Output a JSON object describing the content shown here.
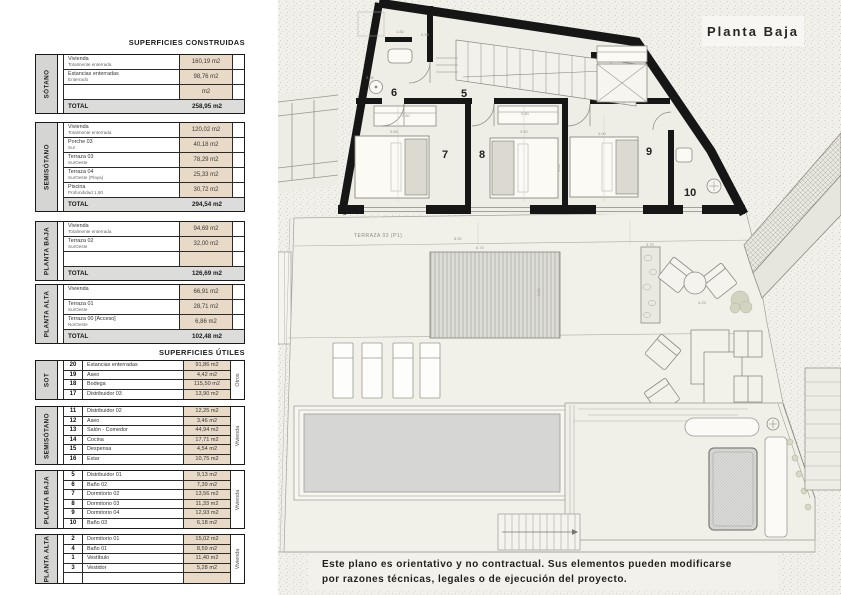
{
  "plan": {
    "title": "Planta Baja",
    "terraza_label": "TERRAZA 02 (P1)",
    "room_numbers": [
      "6",
      "5",
      "7",
      "8",
      "9",
      "10"
    ],
    "dims": [
      "1.82",
      "0.96",
      "2.35",
      "0.60",
      "3.50",
      "0.60",
      "3.50",
      "4.00",
      "5.05",
      "8.50",
      "6.74",
      "2.62",
      "3.70",
      "4.25"
    ]
  },
  "disclaimer": {
    "line1": "Este plano es orientativo y no contractual. Sus elementos pueden modificarse",
    "line2": "por razones técnicas, legales o de ejecución del proyecto."
  },
  "construidas": {
    "heading": "SUPERFICIES CONSTRUIDAS",
    "total_label": "TOTAL",
    "sections": [
      {
        "floor": "SÓTANO",
        "rows": [
          {
            "label": "Vivienda",
            "sublabel": "Totalmente enterrada",
            "value": "160,19 m2"
          },
          {
            "label": "Estancias enterradas",
            "sublabel": "Enterrado",
            "value": "98,76 m2"
          },
          {
            "label": "",
            "sublabel": "",
            "value": "m2"
          }
        ],
        "total_value": "258,95 m2"
      },
      {
        "floor": "SEMISÓTANO",
        "rows": [
          {
            "label": "Vivienda",
            "sublabel": "Totalmente enterrada",
            "value": "120,02 m2"
          },
          {
            "label": "Porche 03",
            "sublabel": "Sur",
            "value": "40,18 m2"
          },
          {
            "label": "Terraza 03",
            "sublabel": "SurOeste",
            "value": "78,29 m2"
          },
          {
            "label": "Terraza 04",
            "sublabel": "SurOeste (Playa)",
            "value": "25,33 m2"
          },
          {
            "label": "Piscina",
            "sublabel": "Profundidad 1,50",
            "value": "30,72 m2"
          }
        ],
        "total_value": "294,54 m2"
      },
      {
        "floor": "PLANTA BAJA",
        "rows": [
          {
            "label": "Vivienda",
            "sublabel": "Totalmente enterrada",
            "value": "94,69 m2"
          },
          {
            "label": "Terraza 02",
            "sublabel": "SurOeste",
            "value": "32,00 m2"
          },
          {
            "label": "",
            "sublabel": "",
            "value": ""
          }
        ],
        "total_value": "126,69 m2"
      },
      {
        "floor": "PLANTA ALTA",
        "rows": [
          {
            "label": "Vivienda",
            "sublabel": "",
            "value": "66,91 m2"
          },
          {
            "label": "Terraza 01",
            "sublabel": "SurOeste",
            "value": "28,71 m2"
          },
          {
            "label": "Terraza 00 [Acceso]",
            "sublabel": "NorOeste",
            "value": "6,86 m2"
          }
        ],
        "total_value": "102,48 m2"
      }
    ]
  },
  "utiles": {
    "heading": "SUPERFICIES ÚTILES",
    "sections": [
      {
        "floor": "SOT",
        "category": "Otros",
        "rows": [
          {
            "num": "20",
            "label": "Estancias enterradas",
            "value": "91,86 m2"
          },
          {
            "num": "19",
            "label": "Aseo",
            "value": "4,42 m2"
          },
          {
            "num": "18",
            "label": "Bodega",
            "value": "115,50 m2"
          },
          {
            "num": "17",
            "label": "Distribuidor 03",
            "value": "13,90 m2"
          }
        ]
      },
      {
        "floor": "SEMISÓTANO",
        "category": "Vivienda",
        "rows": [
          {
            "num": "11",
            "label": "Distribuidor 02",
            "value": "12,25 m2"
          },
          {
            "num": "12",
            "label": "Aseo",
            "value": "3,46 m2"
          },
          {
            "num": "13",
            "label": "Salón - Comedor",
            "value": "44,94 m2"
          },
          {
            "num": "14",
            "label": "Cocina",
            "value": "17,71 m2"
          },
          {
            "num": "15",
            "label": "Despensa",
            "value": "4,54 m2"
          },
          {
            "num": "16",
            "label": "Estar",
            "value": "10,75 m2"
          }
        ]
      },
      {
        "floor": "PLANTA BAJA",
        "category": "Vivienda",
        "rows": [
          {
            "num": "5",
            "label": "Distribuidor 01",
            "value": "9,13 m2"
          },
          {
            "num": "6",
            "label": "Baño 02",
            "value": "7,39 m2"
          },
          {
            "num": "7",
            "label": "Dormitorio 02",
            "value": "13,56 m2"
          },
          {
            "num": "8",
            "label": "Dormitorio 03",
            "value": "11,33 m2"
          },
          {
            "num": "9",
            "label": "Dormitorio 04",
            "value": "12,93 m2"
          },
          {
            "num": "10",
            "label": "Baño 03",
            "value": "6,18 m2"
          }
        ]
      },
      {
        "floor": "PLANTA ALTA",
        "category": "Vivienda",
        "rows": [
          {
            "num": "2",
            "label": "Dormitorio 01",
            "value": "15,02 m2"
          },
          {
            "num": "4",
            "label": "Baño 01",
            "value": "8,59 m2"
          },
          {
            "num": "1",
            "label": "Vestíbulo",
            "value": "11,40 m2"
          },
          {
            "num": "3",
            "label": "Vestidor",
            "value": "5,28 m2"
          },
          {
            "num": "",
            "label": "",
            "value": ""
          }
        ]
      }
    ]
  }
}
